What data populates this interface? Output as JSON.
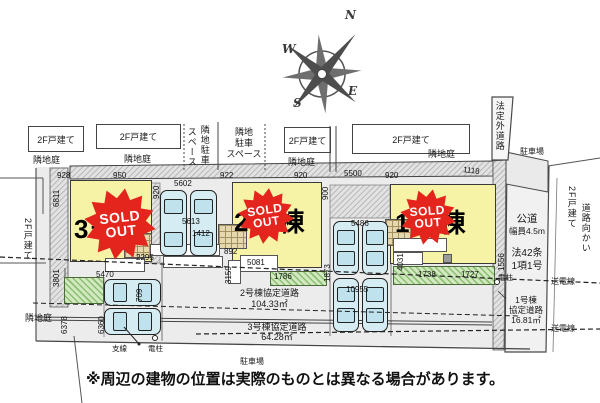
{
  "compass": {
    "n": "N",
    "e": "E",
    "s": "S",
    "w": "W"
  },
  "neighbors": {
    "house1": "2F戸建て",
    "garden1": "隣地庭",
    "house2": "2F戸建て",
    "garden2": "隣地庭",
    "parking_v_col1": "スペース",
    "parking_v_col2": "隣地駐車",
    "parking_h_l1": "隣地",
    "parking_h_l2": "駐車",
    "parking_h_l3": "スペース",
    "house3": "2F戸建て",
    "garden3": "隣地庭",
    "house4": "2F戸建て",
    "garden4": "隣地庭",
    "west_house": "2F戸建て",
    "west_garden": "隣地庭",
    "east_house_l1": "2F戸建て",
    "east_house_l2": "道路向かい"
  },
  "buildings": [
    {
      "name": "1号棟"
    },
    {
      "name": "2号棟"
    },
    {
      "name": "3号棟"
    }
  ],
  "sold": {
    "l1": "SOLD",
    "l2": "OUT"
  },
  "roads": {
    "public": {
      "name": "公道",
      "width": "幅員4.5m",
      "law1": "法42条",
      "law2": "1項1号"
    },
    "unofficial": "法定外道路",
    "k1": {
      "l1": "1号棟",
      "l2": "協定道路",
      "area": "16.81㎡"
    },
    "k2": {
      "label": "2号棟協定道路",
      "area": "104.33㎡"
    },
    "k3": {
      "label": "3号棟協定道路",
      "area": "64.28㎡"
    }
  },
  "site": {
    "parking_ne": "駐車場",
    "parking_s": "駐車場",
    "power_line_1": "送電線",
    "power_line_2": "送電線",
    "pole_right": "電柱",
    "pole_bottom": "電柱",
    "guy_wire": "支線"
  },
  "dims": {
    "t1": "928",
    "t2": "950",
    "t3": "5602",
    "t4": "922",
    "t5": "920",
    "t6": "5500",
    "t7": "920",
    "t8": "1118",
    "l1": "6811",
    "l2": "920",
    "l3": "900",
    "l4": "1556",
    "p1": "5613",
    "p2": "1412",
    "p3": "5486",
    "p4": "10955",
    "b1": "2295",
    "b2": "5470",
    "b3": "892",
    "b4": "5081",
    "b5": "3159",
    "b6": "1786",
    "b7": "1738",
    "b8": "1727",
    "b9": "4031",
    "b10": "1873",
    "w1": "6378",
    "w2": "6360",
    "w3": "709",
    "w4": "3801"
  },
  "disclaimer": "※周辺の建物の位置は実際のものとは異なる場合があります。"
}
